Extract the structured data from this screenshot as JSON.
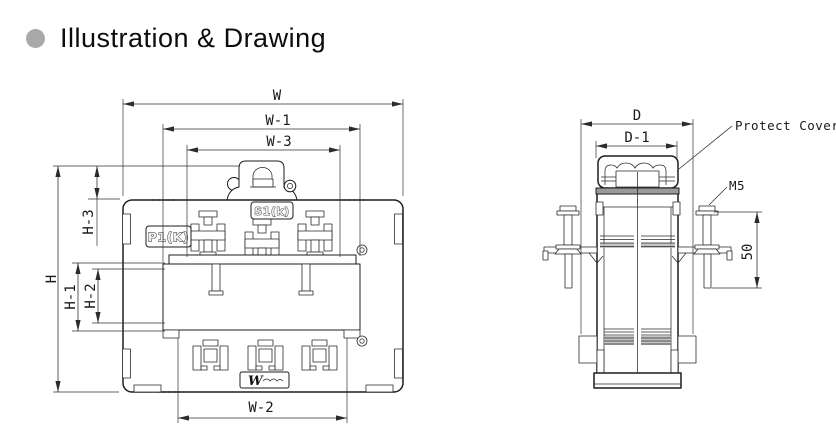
{
  "header": {
    "title": "Illustration & Drawing"
  },
  "front_view": {
    "dims": {
      "w": "W",
      "w1": "W-1",
      "w3": "W-3",
      "w2": "W-2",
      "h": "H",
      "h1": "H-1",
      "h2": "H-2",
      "h3": "H-3"
    },
    "markings": {
      "primary_terminal": "P1(K)",
      "secondary_terminal": "S1(k)",
      "logo": "W"
    }
  },
  "side_view": {
    "dims": {
      "d": "D",
      "d1": "D-1",
      "screw_length": "50"
    },
    "annotations": {
      "protect_cover": "Protect Cover",
      "screw_size": "M5"
    }
  },
  "colors": {
    "line": "#1d1d1d",
    "dimension": "#333333",
    "shade": "#b5b5b5",
    "title_bullet": "#a9a9a9",
    "background": "#ffffff"
  }
}
